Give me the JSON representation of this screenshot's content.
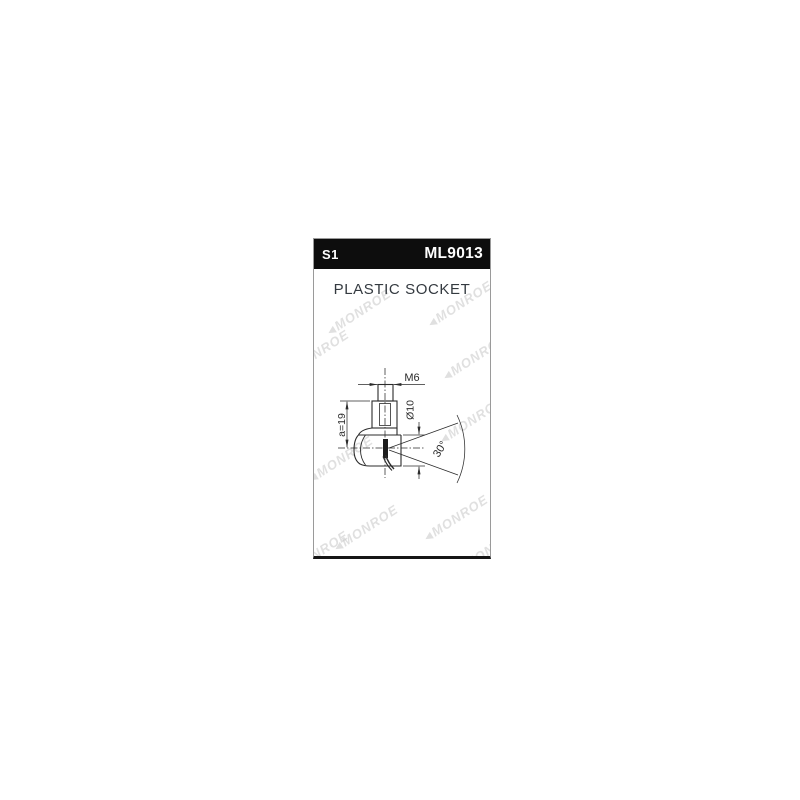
{
  "panel": {
    "header": {
      "code": "S1",
      "part_number": "ML9013"
    },
    "title": "PLASTIC SOCKET",
    "watermark": "MONROE"
  },
  "diagram": {
    "thread_label": "M6",
    "diameter_label": "Ø10",
    "length_label": "a=19",
    "angle_label": "30°"
  },
  "colors": {
    "header_bg": "#0d0d0d",
    "header_text": "#ffffff",
    "title_text": "#343a40",
    "drawing_line": "#2b2b2b",
    "watermark": "#c7c7c7",
    "card_border": "#9a9a9a"
  }
}
